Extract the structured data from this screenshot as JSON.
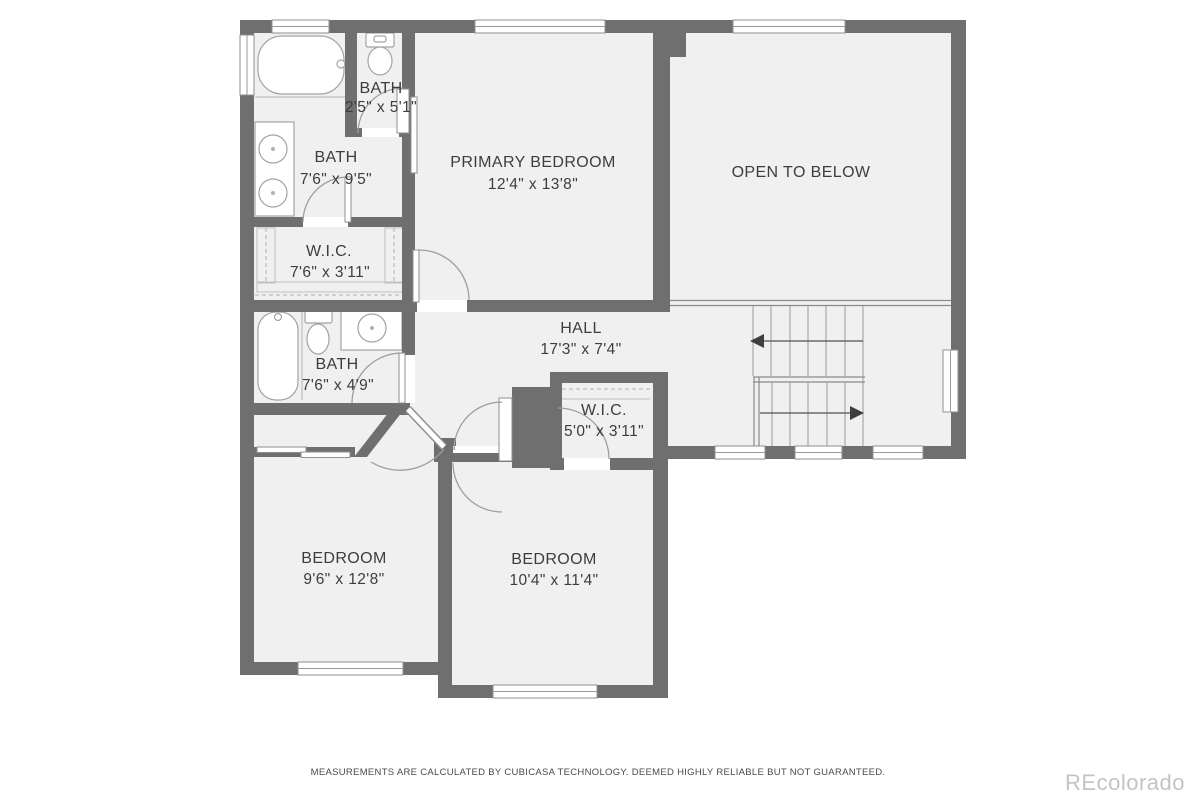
{
  "rooms": {
    "bath_small": {
      "name": "BATH",
      "dims": "2'5\" x 5'1\""
    },
    "bath_primary": {
      "name": "BATH",
      "dims": "7'6\" x 9'5\""
    },
    "wic_primary": {
      "name": "W.I.C.",
      "dims": "7'6\" x 3'11\""
    },
    "primary_bedroom": {
      "name": "PRIMARY BEDROOM",
      "dims": "12'4\" x 13'8\""
    },
    "open_to_below": {
      "name": "OPEN TO BELOW"
    },
    "hall": {
      "name": "HALL",
      "dims": "17'3\" x 7'4\""
    },
    "bath_hall": {
      "name": "BATH",
      "dims": "7'6\" x 4'9\""
    },
    "wic_hall": {
      "name": "W.I.C.",
      "dims": "5'0\" x 3'11\""
    },
    "bedroom_left": {
      "name": "BEDROOM",
      "dims": "9'6\" x 12'8\""
    },
    "bedroom_right": {
      "name": "BEDROOM",
      "dims": "10'4\" x 11'4\""
    }
  },
  "icons": {
    "stair_direction_up": "arrow-left",
    "stair_direction_down": "arrow-right"
  },
  "fixtures": [
    "bathtub",
    "toilet",
    "double-sink-vanity",
    "sink-vanity",
    "staircase",
    "closet-shelving"
  ],
  "colors": {
    "wall": "#6f6f6f",
    "floor": "#f0f0f0",
    "label_text": "#3d3d3d",
    "watermark": "#c4c4c4"
  },
  "footer": {
    "disclaimer": "MEASUREMENTS ARE CALCULATED BY CUBICASA TECHNOLOGY. DEEMED HIGHLY RELIABLE BUT NOT GUARANTEED.",
    "watermark": "REcolorado"
  }
}
